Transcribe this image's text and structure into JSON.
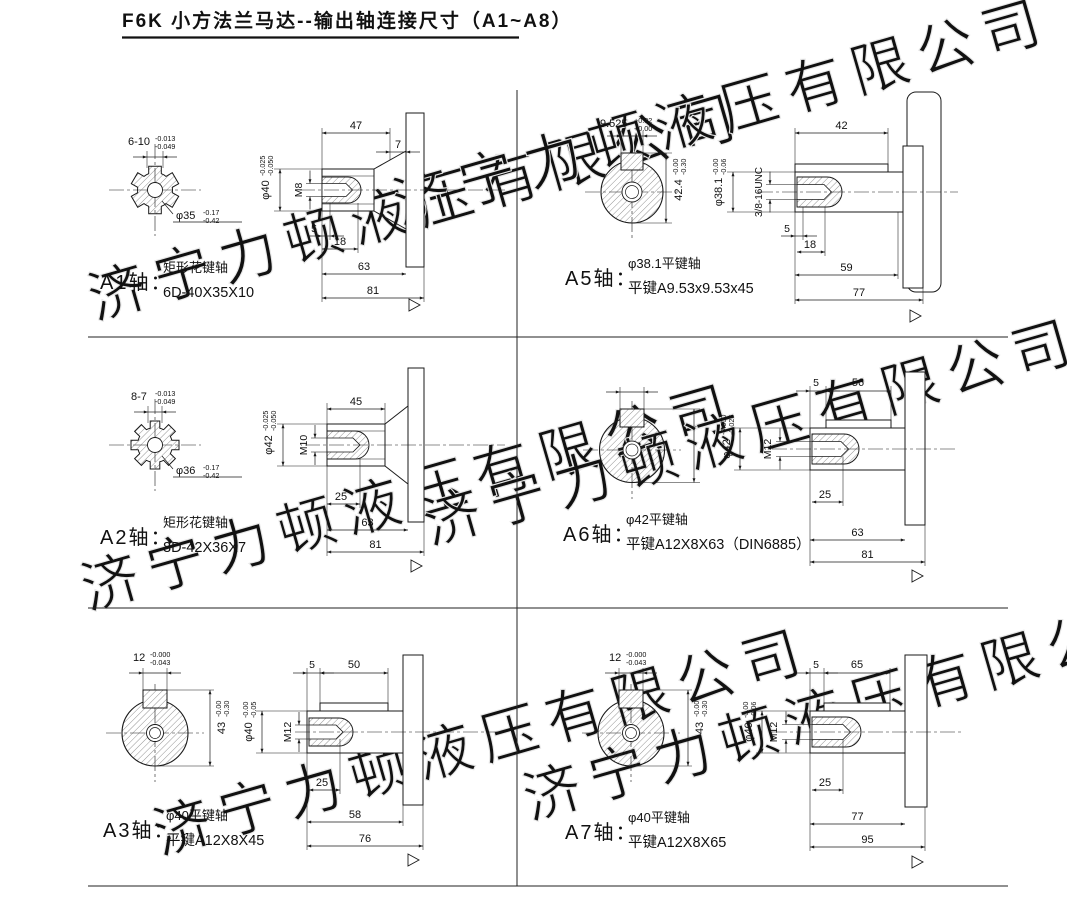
{
  "title": "F6K 小方法兰马达--输出轴连接尺寸（A1~A8）",
  "watermark": "济宁力顿液压有限公司",
  "panels": {
    "a1": {
      "label": "A1轴：",
      "desc1": "矩形花键轴",
      "desc2": "6D-40X35X10",
      "spline_w": "6-10",
      "spline_tu": "-0.013",
      "spline_tl": "-0.049",
      "od": "φ35",
      "od_tu": "-0.17",
      "od_tl": "-0.42",
      "shaft": "φ40",
      "shaft_tu": "-0.025",
      "shaft_tl": "-0.050",
      "thread": "M8",
      "len_spline": "47",
      "len_tip": "7",
      "gap": "5",
      "thread_depth": "18",
      "len_shaft": "63",
      "len_total": "81"
    },
    "a2": {
      "label": "A2轴：",
      "desc1": "矩形花键轴",
      "desc2": "8D-42X36X7",
      "spline_w": "8-7",
      "spline_tu": "-0.013",
      "spline_tl": "-0.049",
      "od": "φ36",
      "od_tu": "-0.17",
      "od_tl": "-0.42",
      "shaft": "φ42",
      "shaft_tu": "-0.025",
      "shaft_tl": "-0.050",
      "thread": "M10",
      "len_spline": "45",
      "thread_depth": "25",
      "len_shaft": "63",
      "len_total": "81"
    },
    "a3": {
      "label": "A3轴：",
      "desc1": "φ40平键轴",
      "desc2": "平键A12X8X45",
      "key_w": "12",
      "key_tu": "-0.000",
      "key_tl": "-0.043",
      "height": "43",
      "height_tu": "-0.00",
      "height_tl": "-0.30",
      "shaft": "φ40",
      "shaft_tu": "-0.00",
      "shaft_tl": "-0.05",
      "thread": "M12",
      "gap": "5",
      "key_len": "50",
      "thread_depth": "25",
      "len_shaft": "58",
      "len_total": "76"
    },
    "a5": {
      "label": "A5轴：",
      "desc1": "φ38.1平键轴",
      "desc2": "平键A9.53x9.53x45",
      "key_w": "9.525",
      "key_tu": "+0.02",
      "key_tl": "+0.00",
      "height": "42.4",
      "height_tu": "-0.00",
      "height_tl": "-0.30",
      "shaft": "φ38.1",
      "shaft_tu": "-0.00",
      "shaft_tl": "-0.06",
      "thread": "3/8-16UNC",
      "key_len": "42",
      "gap": "5",
      "thread_depth": "18",
      "len_shaft": "59",
      "len_total": "77"
    },
    "a6": {
      "label": "A6轴：",
      "desc1": "φ42平键轴",
      "desc2": "平键A12X8X63（DIN6885）",
      "shaft": "φ42",
      "shaft_tu": "-0.000",
      "shaft_tl": "-0.025",
      "thread": "M12",
      "gap": "5",
      "key_len": "56",
      "thread_depth": "25",
      "len_shaft": "63",
      "len_total": "81"
    },
    "a7": {
      "label": "A7轴：",
      "desc1": "φ40平键轴",
      "desc2": "平键A12X8X65",
      "key_w": "12",
      "key_tu": "-0.000",
      "key_tl": "-0.043",
      "height": "43",
      "height_tu": "-0.00",
      "height_tl": "-0.30",
      "shaft": "φ40",
      "shaft_tu": "-0.00",
      "shaft_tl": "-0.06",
      "thread": "M12",
      "gap": "5",
      "key_len": "65",
      "thread_depth": "25",
      "len_shaft": "77",
      "len_total": "95"
    }
  }
}
